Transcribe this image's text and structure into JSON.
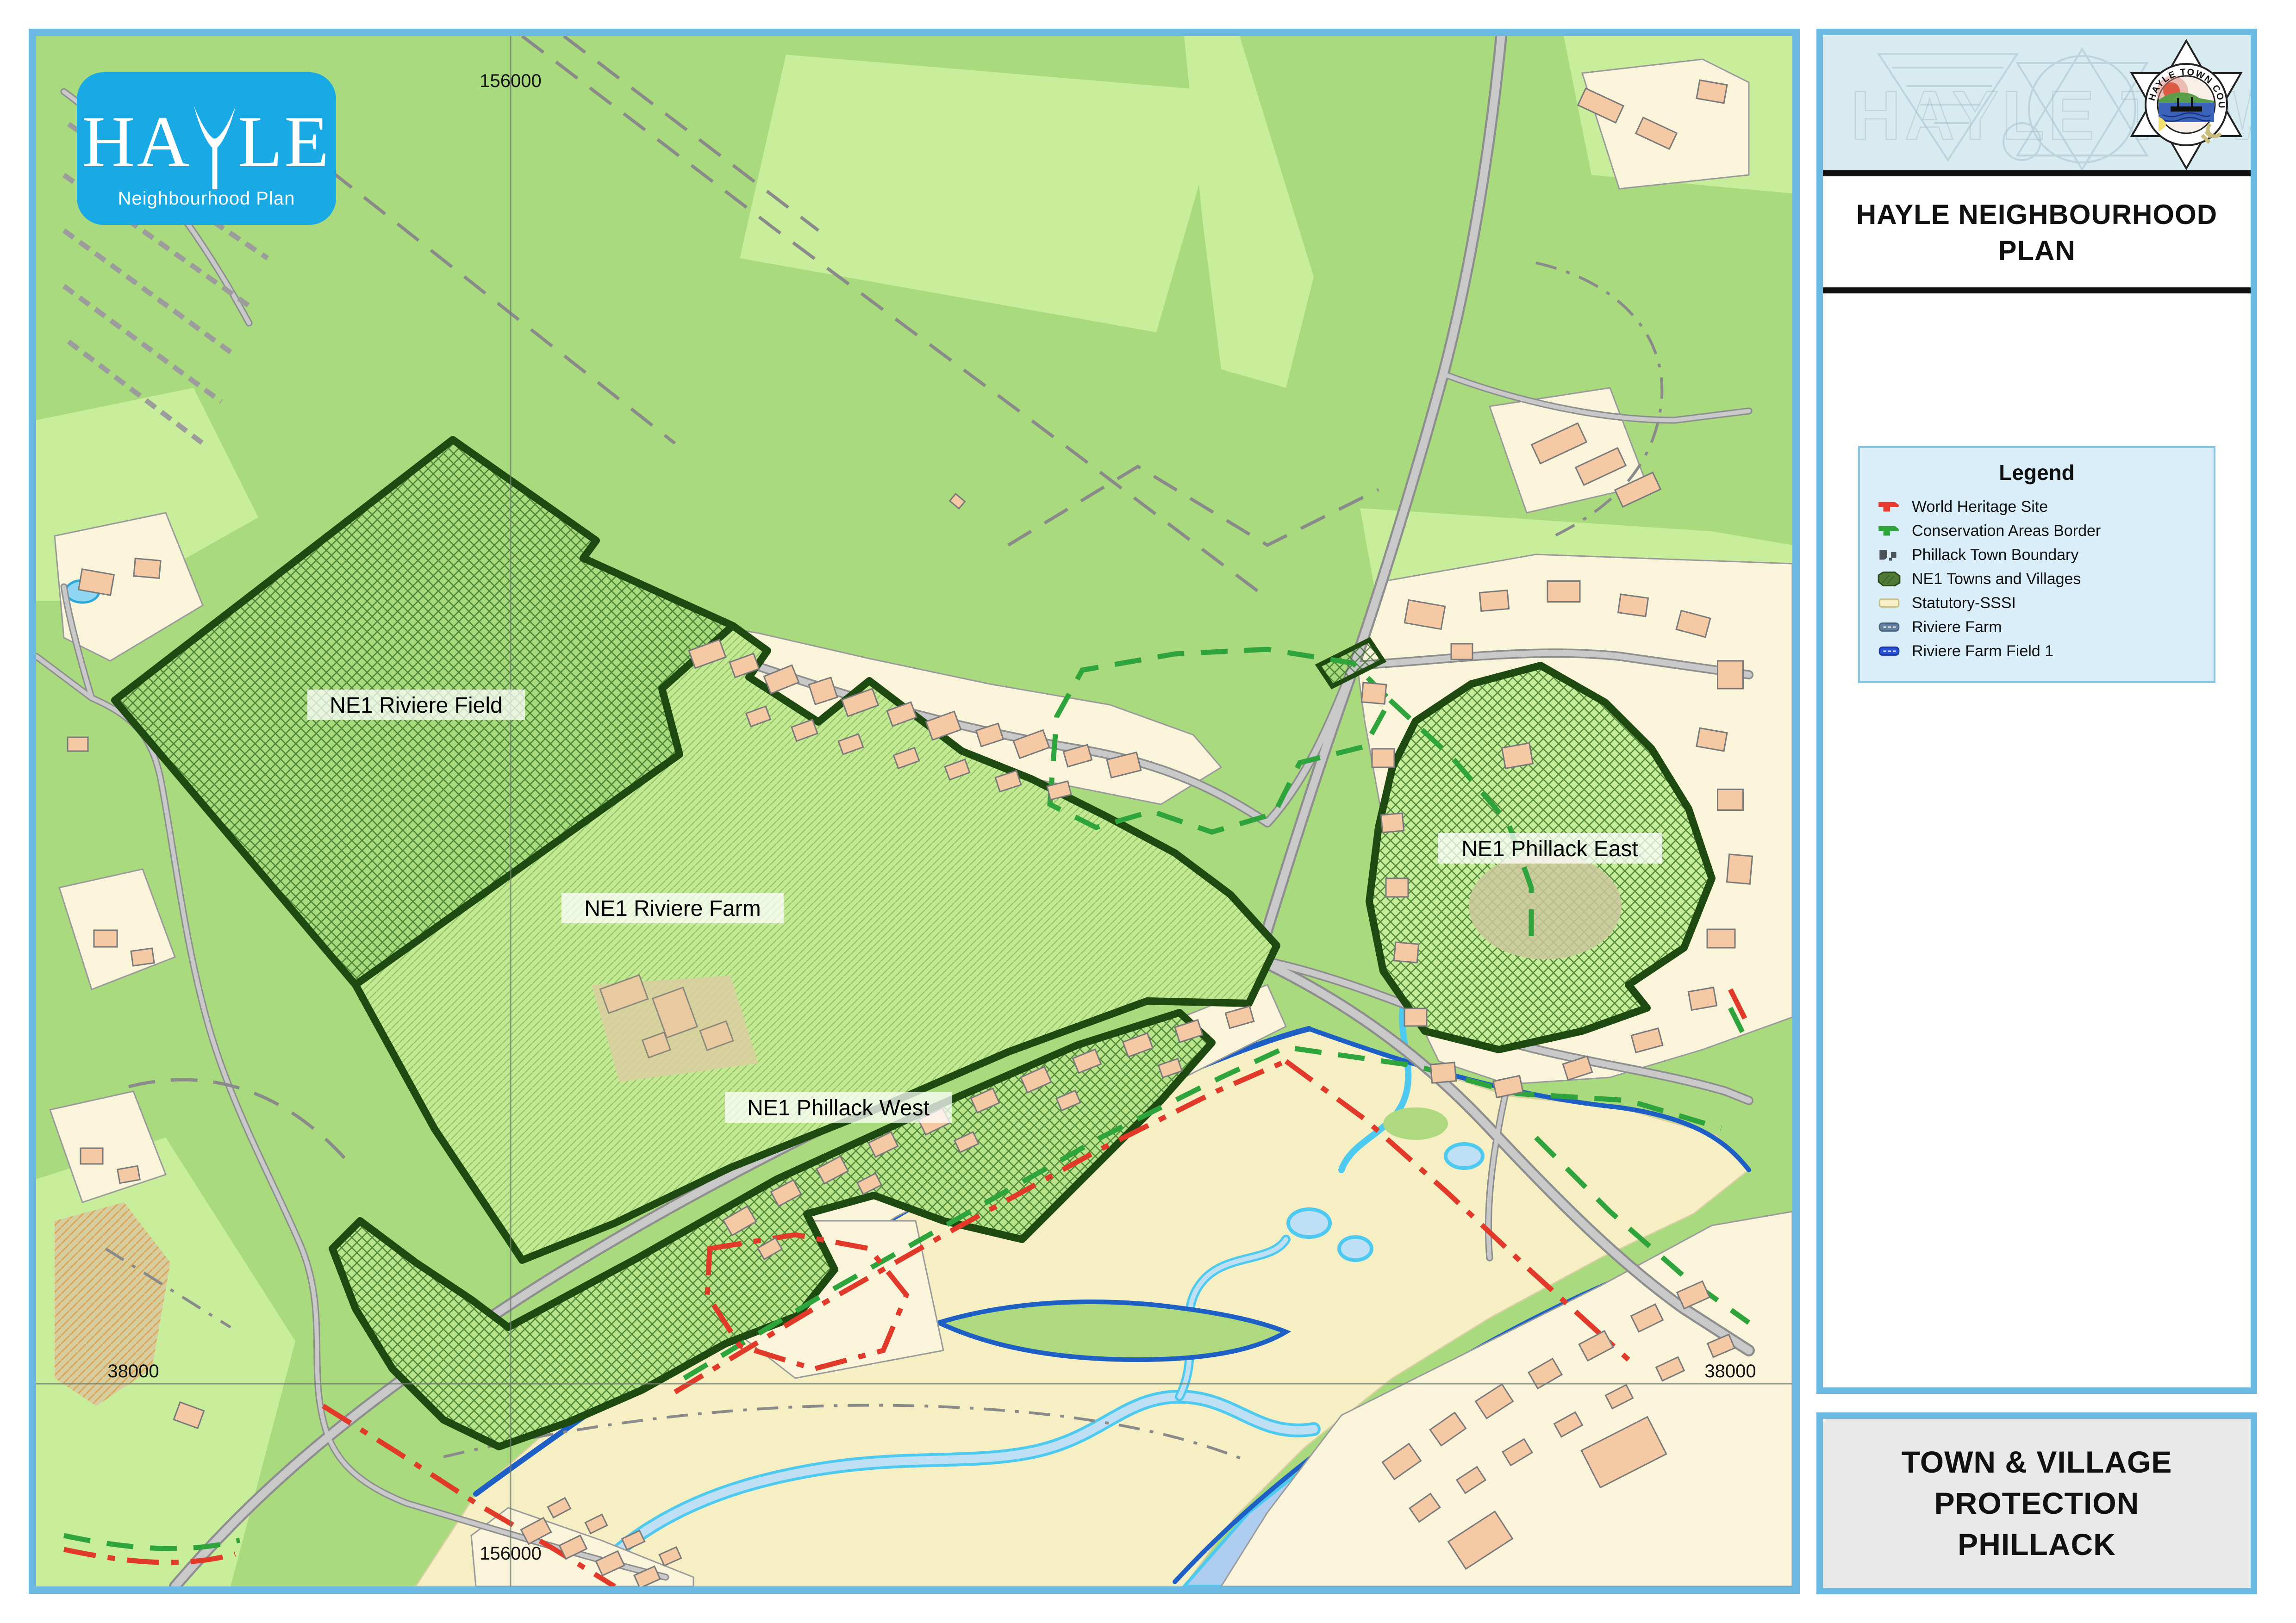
{
  "logo": {
    "title": "HAYLE",
    "subtitle": "Neighbourhood Plan"
  },
  "side_panel": {
    "title_lines": [
      "HAYLE NEIGHBOURHOOD",
      "PLAN"
    ],
    "crest_text": "HAYLE TOWN COUNCIL"
  },
  "legend": {
    "title": "Legend",
    "items": [
      {
        "label": "World Heritage Site",
        "color": "#E8392E"
      },
      {
        "label": "Conservation Areas Border",
        "color": "#2FA43C"
      },
      {
        "label": "Phillack Town Boundary",
        "color": "#4A5358"
      },
      {
        "label": "NE1 Towns and Villages",
        "color": "#4E7A36"
      },
      {
        "label": "Statutory-SSSI",
        "color": "#F5F0C8"
      },
      {
        "label": "Riviere Farm",
        "color": "#64809F"
      },
      {
        "label": "Riviere Farm Field 1",
        "color": "#2B52D4"
      }
    ]
  },
  "map": {
    "area_labels": [
      "NE1 Riviere Field",
      "NE1 Riviere Farm",
      "NE1 Phillack West",
      "NE1 Phillack East"
    ],
    "grid": {
      "top": "156000",
      "bottom": "156000",
      "left": "38000",
      "right": "38000"
    }
  },
  "footer": {
    "lines": [
      "TOWN & VILLAGE",
      "PROTECTION",
      "PHILLACK"
    ]
  },
  "colors": {
    "frame": "#6CB9E3",
    "map_green": "#A9DA7E",
    "field_light": "#C8EE9B",
    "settlement": "#F9F4DA",
    "building": "#F5C9A4",
    "sand": "#F6EFC4",
    "water_line": "#1D5FC4",
    "channel": "#4EC9F0",
    "ne1_border": "#1E4A12",
    "whs_red": "#E23A2A",
    "conservation_green": "#2FA43C",
    "logo_blue": "#19A9E5"
  }
}
